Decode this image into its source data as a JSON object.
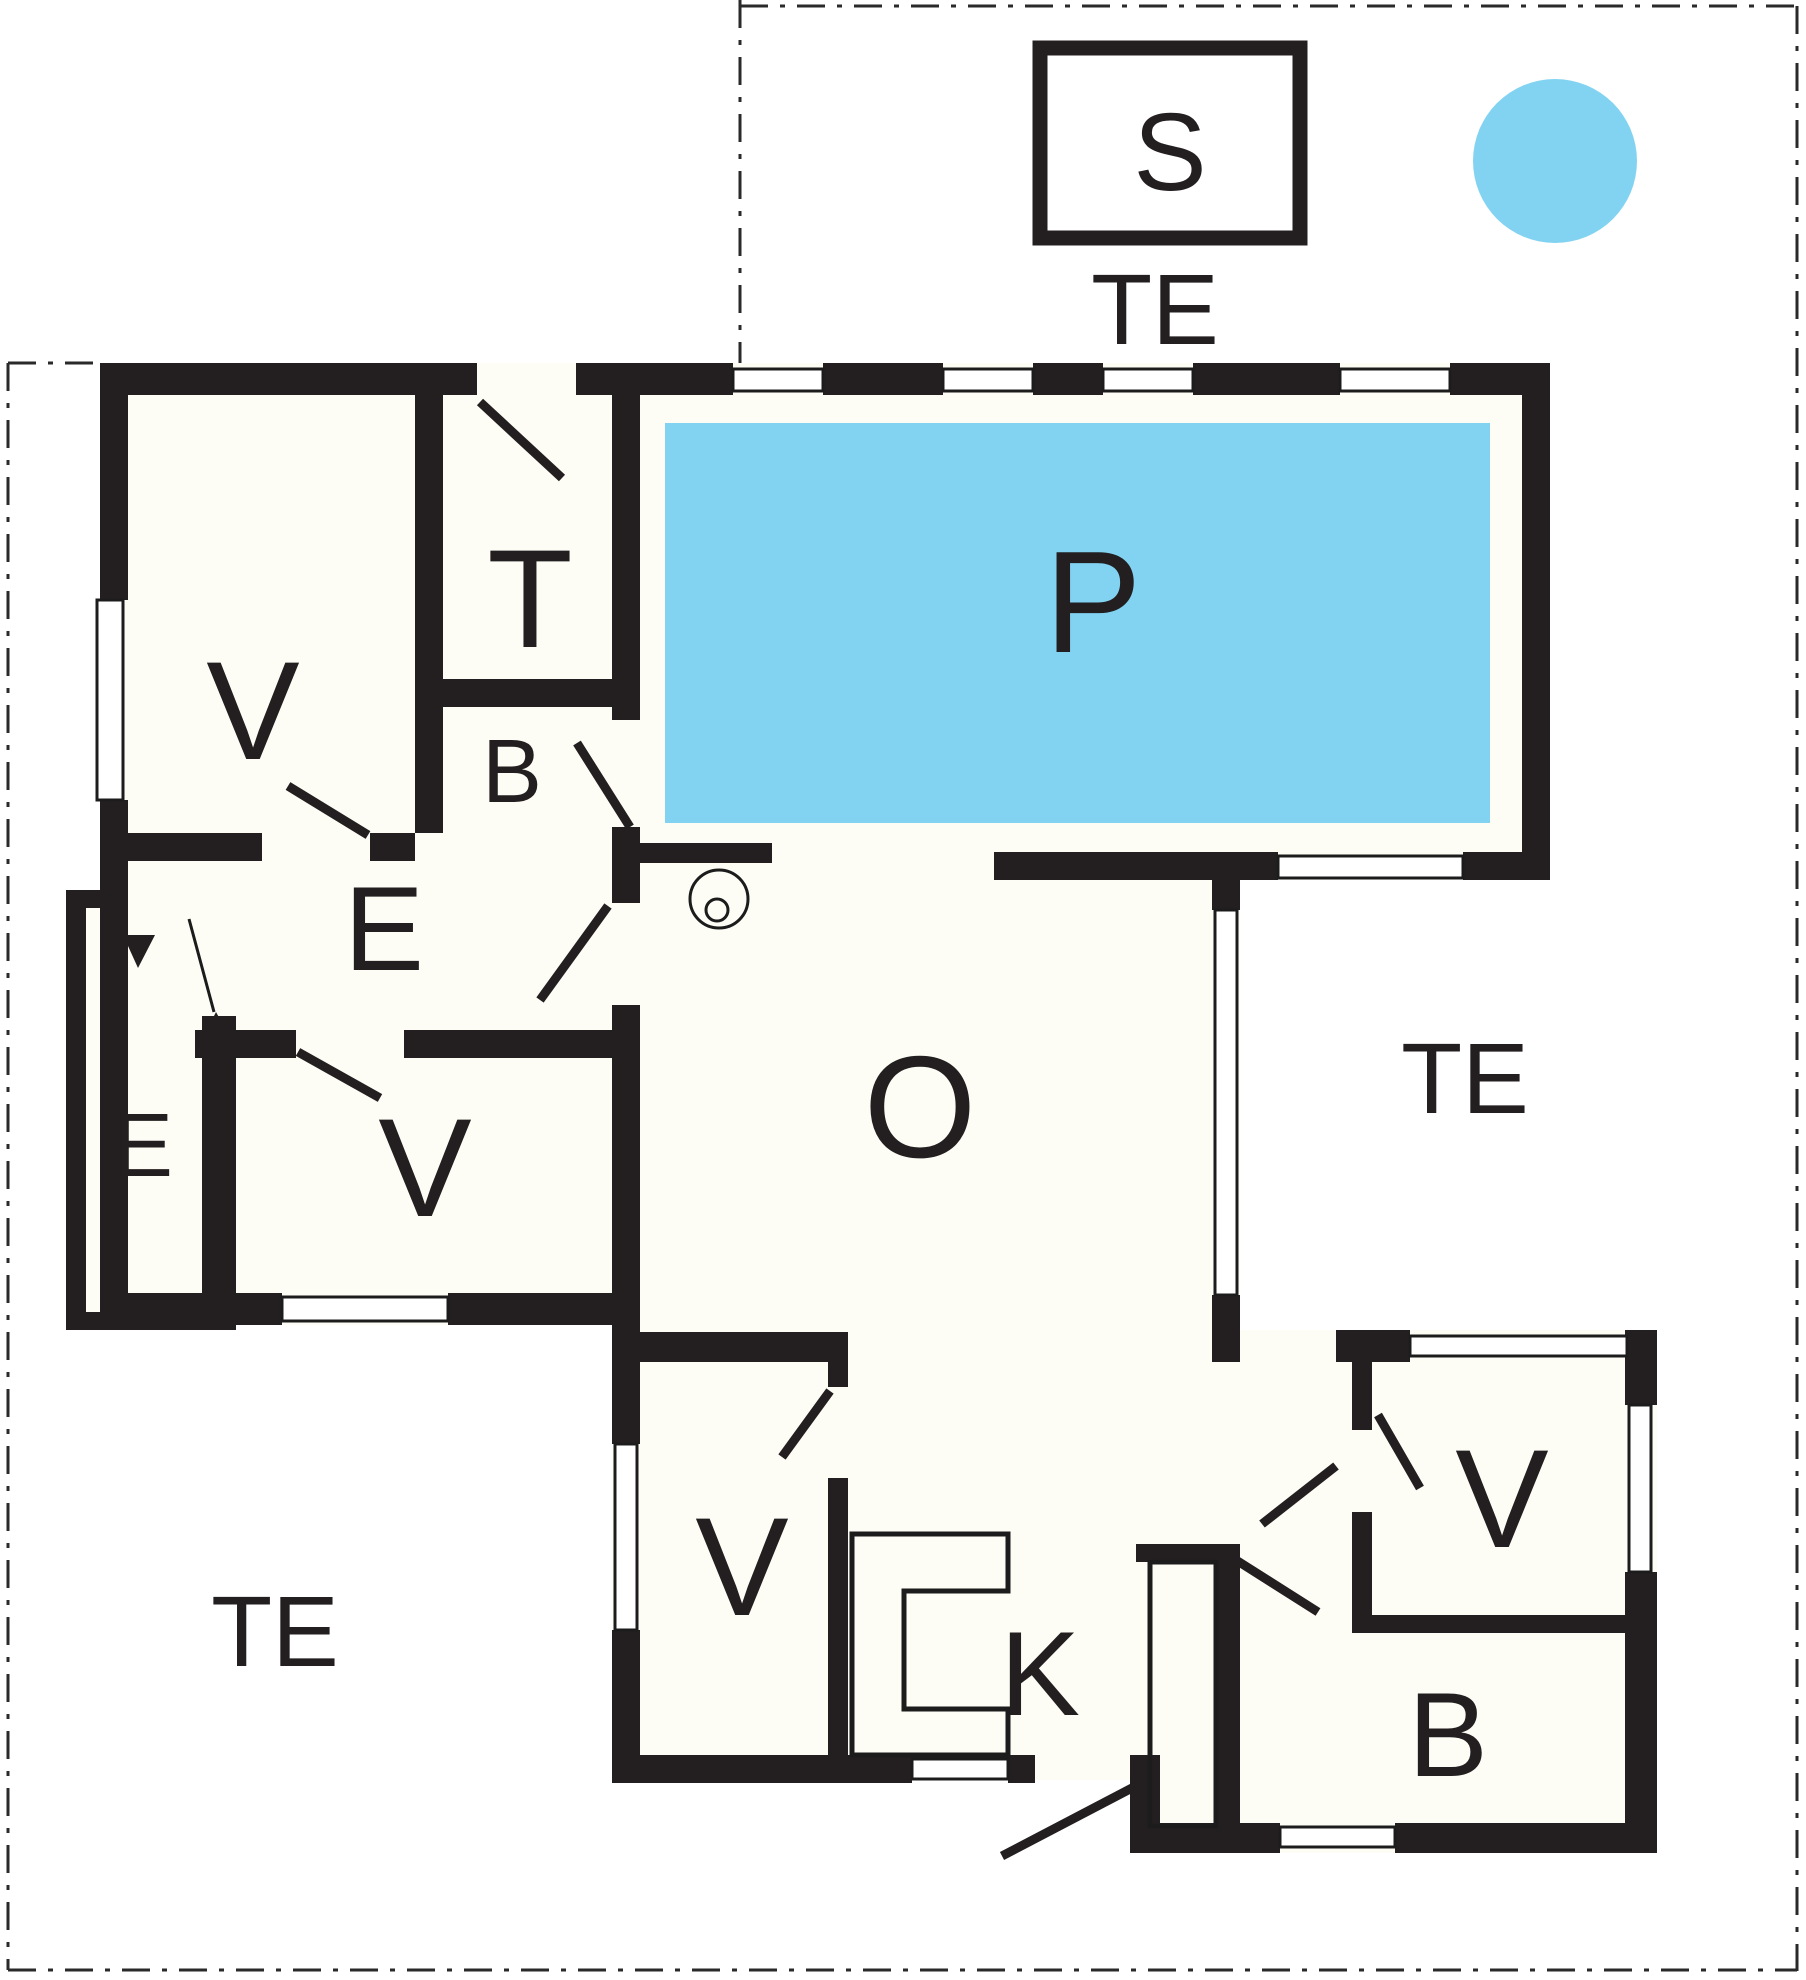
{
  "plan": {
    "title": "holiday-house-floor-plan",
    "labels": {
      "sauna": "S",
      "terrace_top": "TE",
      "terrace_right": "TE",
      "terrace_bottom_left": "TE",
      "pool": "P",
      "living_room": "O",
      "kitchen": "K",
      "toilet": "T",
      "bath_top": "B",
      "bath_bottom_right": "B",
      "entrance_hall": "E",
      "entry_porch": "E",
      "bedroom_top_left": "V",
      "bedroom_mid_left": "V",
      "bedroom_bottom_center": "V",
      "bedroom_bottom_right": "V"
    },
    "colors": {
      "pool_water": "#82D3F2",
      "hot_tub": "#82D3F2",
      "wall": "#231F20",
      "floor": "#FDFDF6",
      "background": "#FFFFFF"
    }
  }
}
